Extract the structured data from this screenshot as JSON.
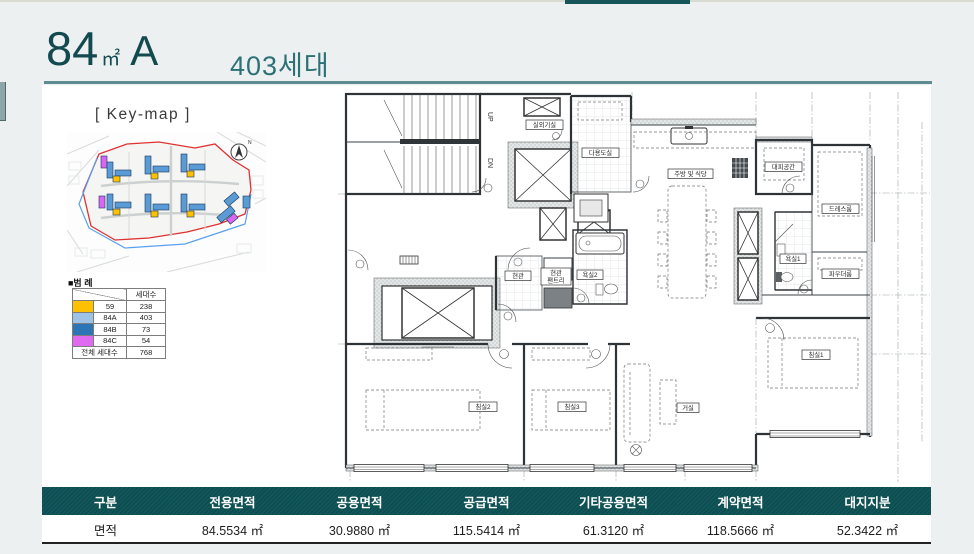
{
  "header": {
    "area": "84",
    "unit": "㎡",
    "type": "A",
    "households": "403세대"
  },
  "keymap": {
    "title": "[ Key-map ]",
    "compass": "N",
    "legend_heading": "■범 례"
  },
  "legend": {
    "count_header": "세대수",
    "rows": [
      {
        "color": "#FFC000",
        "type": "59",
        "count": "238"
      },
      {
        "color": "#9DC3E6",
        "type": "84A",
        "count": "403"
      },
      {
        "color": "#2E75B6",
        "type": "84B",
        "count": "73"
      },
      {
        "color": "#E06BF0",
        "type": "84C",
        "count": "54"
      }
    ],
    "total_label": "전체 세대수",
    "total_value": "768"
  },
  "floorplan": {
    "stair_up": "UP",
    "stair_dn": "DN",
    "labels": {
      "outdoor_unit": "실외기실",
      "utility": "다용도실",
      "kitchen_dining": "주방 및 식당",
      "shelter": "대피공간",
      "dressroom": "드레스룸",
      "bath1": "욕실1",
      "powder": "파우더룸",
      "bath2": "욕실2",
      "entrance": "현관",
      "pantry_line1": "현관",
      "pantry_line2": "팬트리",
      "bed1": "침실1",
      "bed2": "침실2",
      "bed3": "침실3",
      "living": "거실"
    }
  },
  "area_table": {
    "headers": [
      "구분",
      "전용면적",
      "공용면적",
      "공급면적",
      "기타공용면적",
      "계약면적",
      "대지지분"
    ],
    "row_label": "면적",
    "values": [
      "84.5534 ㎡",
      "30.9880 ㎡",
      "115.5414 ㎡",
      "61.3120 ㎡",
      "118.5666 ㎡",
      "52.3422 ㎡"
    ]
  },
  "colors": {
    "page_bg": "#EDF0F1",
    "accent_dark": "#124A50",
    "accent": "#2C7176",
    "rule": "#5E8C90",
    "table_header_bg": "#0C4F52",
    "top_accent": "#16565A",
    "keymap_red": "#E03131",
    "keymap_blue": "#58A0EE"
  }
}
